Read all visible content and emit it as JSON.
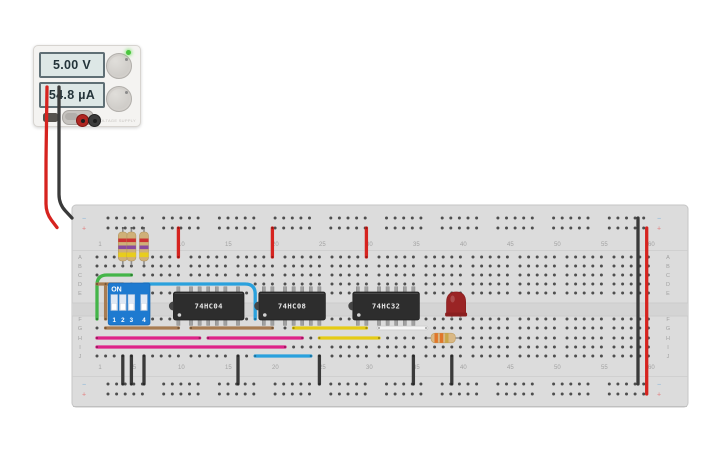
{
  "canvas": {
    "width": 725,
    "height": 453,
    "background": "#ffffff"
  },
  "power_supply": {
    "voltage_display": "5.00 V",
    "current_display": "54.8 µA",
    "brand_label": "VOLTAGE SUPPLY",
    "power_led_color": "#49c53d"
  },
  "breadboard": {
    "row_labels_top": [
      "A",
      "B",
      "C",
      "D",
      "E"
    ],
    "row_labels_bottom": [
      "F",
      "G",
      "H",
      "I",
      "J"
    ],
    "column_numbers": [
      1,
      5,
      10,
      15,
      20,
      25,
      30,
      35,
      40,
      45,
      50,
      55,
      60
    ],
    "negative_symbol": "−",
    "positive_symbol": "+",
    "board_color": "#dcdcdc",
    "channel_color": "#d4d4d4",
    "hole_color": "#4e4e4e",
    "label_color": "#a2a2a2",
    "negative_color": "#7fb2d9",
    "positive_color": "#e27d7d"
  },
  "components": {
    "ics": [
      {
        "label": "74HC04",
        "start_col": 10,
        "end_col": 16
      },
      {
        "label": "74HC08",
        "start_col": 19,
        "end_col": 25
      },
      {
        "label": "74HC32",
        "start_col": 29,
        "end_col": 35
      }
    ],
    "dip_switch": {
      "on_label": "ON",
      "switch_labels": [
        "1",
        "2",
        "3",
        "4"
      ],
      "start_col": 3,
      "end_col": 6,
      "body_color": "#1e7ad0",
      "state": "all_off"
    },
    "vertical_resistors": {
      "cols": [
        4,
        5,
        6
      ],
      "body_color": "#cfb078",
      "band_colors": [
        "#cb3333",
        "#8a4a9e",
        "#e8cd1d"
      ]
    },
    "horizontal_resistor": {
      "row": "H",
      "start_col": 36,
      "end_col": 40,
      "body_color": "#d9b885",
      "band_colors": [
        "#e0762a",
        "#e0762a",
        "#c9a648"
      ]
    },
    "led": {
      "row": "F",
      "cols": [
        39,
        40
      ],
      "body_color": "#9a2425",
      "flange_color": "#8a1f20"
    }
  },
  "wires": [
    {
      "name": "supply-red-wire",
      "color": "#d6231f",
      "px": [
        [
          47,
          87
        ],
        [
          46,
          160
        ],
        [
          46,
          213
        ],
        [
          57,
          227.5
        ]
      ]
    },
    {
      "name": "supply-black-wire",
      "color": "#3a3a3a",
      "px": [
        [
          59,
          87
        ],
        [
          59,
          150
        ],
        [
          59,
          204
        ],
        [
          72,
          218
        ]
      ]
    },
    {
      "name": "rail-bridge-negative",
      "color": "#3a3a3a",
      "px": [
        [
          638,
          218
        ],
        [
          638,
          384
        ]
      ]
    },
    {
      "name": "rail-bridge-positive",
      "color": "#d6231f",
      "px": [
        [
          646.7,
          228
        ],
        [
          646.7,
          394
        ]
      ]
    },
    {
      "name": "power-drop-col10",
      "color": "#d6231f",
      "pts": [
        [
          10,
          "T2"
        ],
        [
          10,
          "A"
        ]
      ]
    },
    {
      "name": "power-drop-col20",
      "color": "#d6231f",
      "pts": [
        [
          20,
          "T2"
        ],
        [
          20,
          "A"
        ]
      ]
    },
    {
      "name": "power-drop-col30",
      "color": "#d6231f",
      "pts": [
        [
          30,
          "T2"
        ],
        [
          30,
          "A"
        ]
      ]
    },
    {
      "name": "green-jumper",
      "color": "#44b549",
      "pts": [
        [
          5,
          "C"
        ],
        [
          1,
          "C"
        ],
        [
          1,
          "F"
        ]
      ]
    },
    {
      "name": "brown-row-d",
      "color": "#a87c52",
      "pts": [
        [
          1,
          "D"
        ],
        [
          4,
          "D"
        ]
      ]
    },
    {
      "name": "brown-vertical",
      "color": "#a87c52",
      "pts": [
        [
          2,
          "D"
        ],
        [
          2,
          "F"
        ]
      ]
    },
    {
      "name": "blue-row-d",
      "color": "#2aa1dd",
      "pts": [
        [
          6,
          "D"
        ],
        [
          18,
          "D"
        ],
        [
          18,
          "F"
        ]
      ]
    },
    {
      "name": "brown-row-g-1",
      "color": "#a87c52",
      "pts": [
        [
          2,
          "G"
        ],
        [
          10,
          "G"
        ]
      ]
    },
    {
      "name": "brown-row-g-2",
      "color": "#a87c52",
      "pts": [
        [
          11,
          "G"
        ],
        [
          20,
          "G"
        ]
      ]
    },
    {
      "name": "yellow-row-g",
      "color": "#e5cb15",
      "pts": [
        [
          22,
          "G"
        ],
        [
          30,
          "G"
        ]
      ]
    },
    {
      "name": "white-row-g",
      "color": "#f5f5f5",
      "outline": true,
      "pts": [
        [
          31,
          "G"
        ],
        [
          36,
          "G"
        ]
      ]
    },
    {
      "name": "magenta-row-h-1",
      "color": "#de2388",
      "pts": [
        [
          1,
          "H"
        ],
        [
          12,
          "H"
        ]
      ]
    },
    {
      "name": "magenta-row-h-2",
      "color": "#de2388",
      "pts": [
        [
          13,
          "H"
        ],
        [
          23,
          "H"
        ]
      ]
    },
    {
      "name": "yellow-row-h",
      "color": "#e5cb15",
      "pts": [
        [
          25,
          "H"
        ],
        [
          31,
          "H"
        ]
      ]
    },
    {
      "name": "magenta-row-i",
      "color": "#de2388",
      "pts": [
        [
          1,
          "I"
        ],
        [
          21,
          "I"
        ]
      ]
    },
    {
      "name": "blue-row-j",
      "color": "#2aa1dd",
      "pts": [
        [
          18,
          "J"
        ],
        [
          24,
          "J"
        ]
      ]
    },
    {
      "name": "ground-col4",
      "color": "#3a3a3a",
      "pts": [
        [
          4,
          "J"
        ],
        [
          4,
          "B1"
        ]
      ]
    },
    {
      "name": "ground-col5",
      "color": "#3a3a3a",
      "pts": [
        [
          5,
          "J"
        ],
        [
          5,
          "B1"
        ]
      ]
    },
    {
      "name": "ground-col6",
      "color": "#3a3a3a",
      "pts": [
        [
          6,
          "J"
        ],
        [
          6,
          "B1"
        ]
      ]
    },
    {
      "name": "ground-col16",
      "color": "#3a3a3a",
      "pts": [
        [
          16,
          "J"
        ],
        [
          16,
          "B1"
        ]
      ]
    },
    {
      "name": "ground-col25",
      "color": "#3a3a3a",
      "pts": [
        [
          25,
          "J"
        ],
        [
          25,
          "B1"
        ]
      ]
    },
    {
      "name": "ground-col35",
      "color": "#3a3a3a",
      "pts": [
        [
          35,
          "J"
        ],
        [
          35,
          "B1"
        ]
      ]
    },
    {
      "name": "ground-col39",
      "color": "#3a3a3a",
      "pts": [
        [
          39,
          "J"
        ],
        [
          39,
          "B1"
        ]
      ]
    }
  ]
}
